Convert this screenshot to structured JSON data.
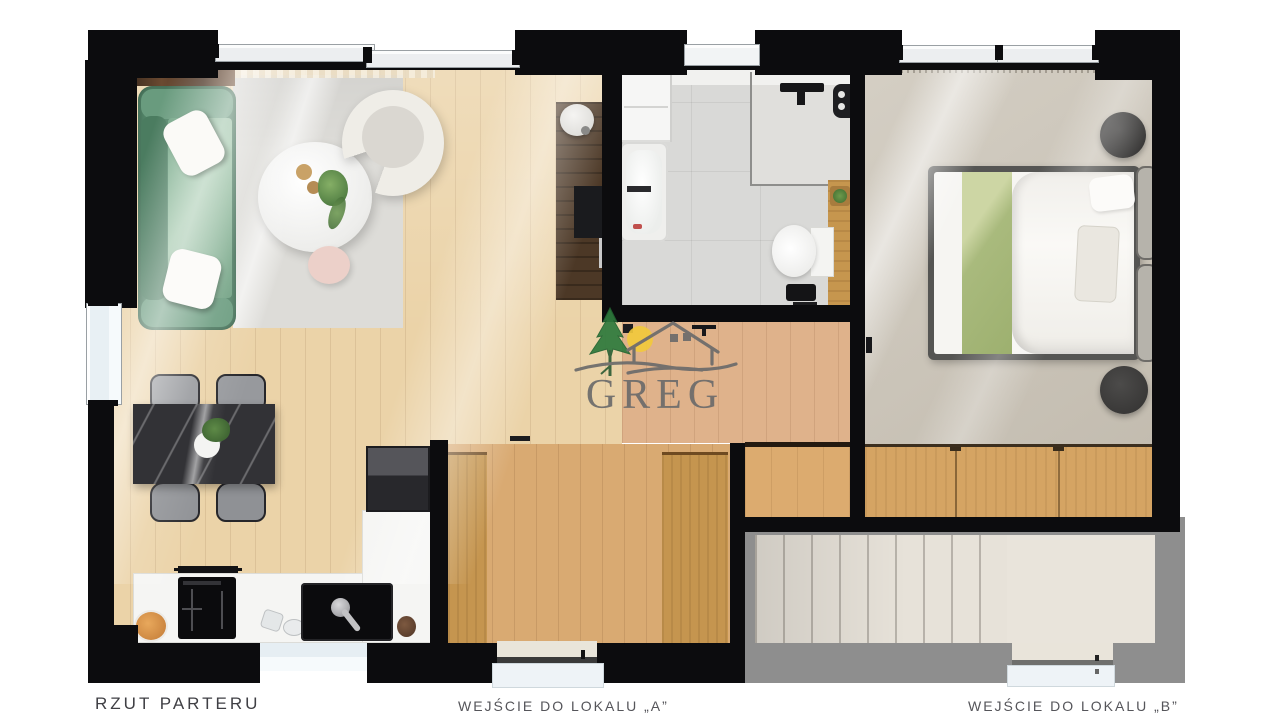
{
  "plan": {
    "title": "RZUT PARTERU",
    "entrances": {
      "a": "WEJŚCIE DO LOKALU „A”",
      "b": "WEJŚCIE DO LOKALU „B”"
    }
  },
  "watermark": {
    "brand": "GREG"
  },
  "palette": {
    "wall": "#0c0c0e",
    "wood_living": "#ebd3a8",
    "wood_hall": "#dfb28b",
    "wood_vestibule": "#d9aa72",
    "wood_wardrobe": "#c5954f",
    "bathroom_tile": "#d9d9d7",
    "bedroom_carpet": "#cbc4b7",
    "sofa_green": "#5f9073",
    "blanket_green": "#aab97e",
    "stairs_gray": "#8e8e8e",
    "stair_step": "#e7e2d9",
    "marble_table": "#323236",
    "logo_tree": "#2e7a3c",
    "logo_sun": "#f2c93c",
    "logo_gray": "#6b6b6b"
  }
}
